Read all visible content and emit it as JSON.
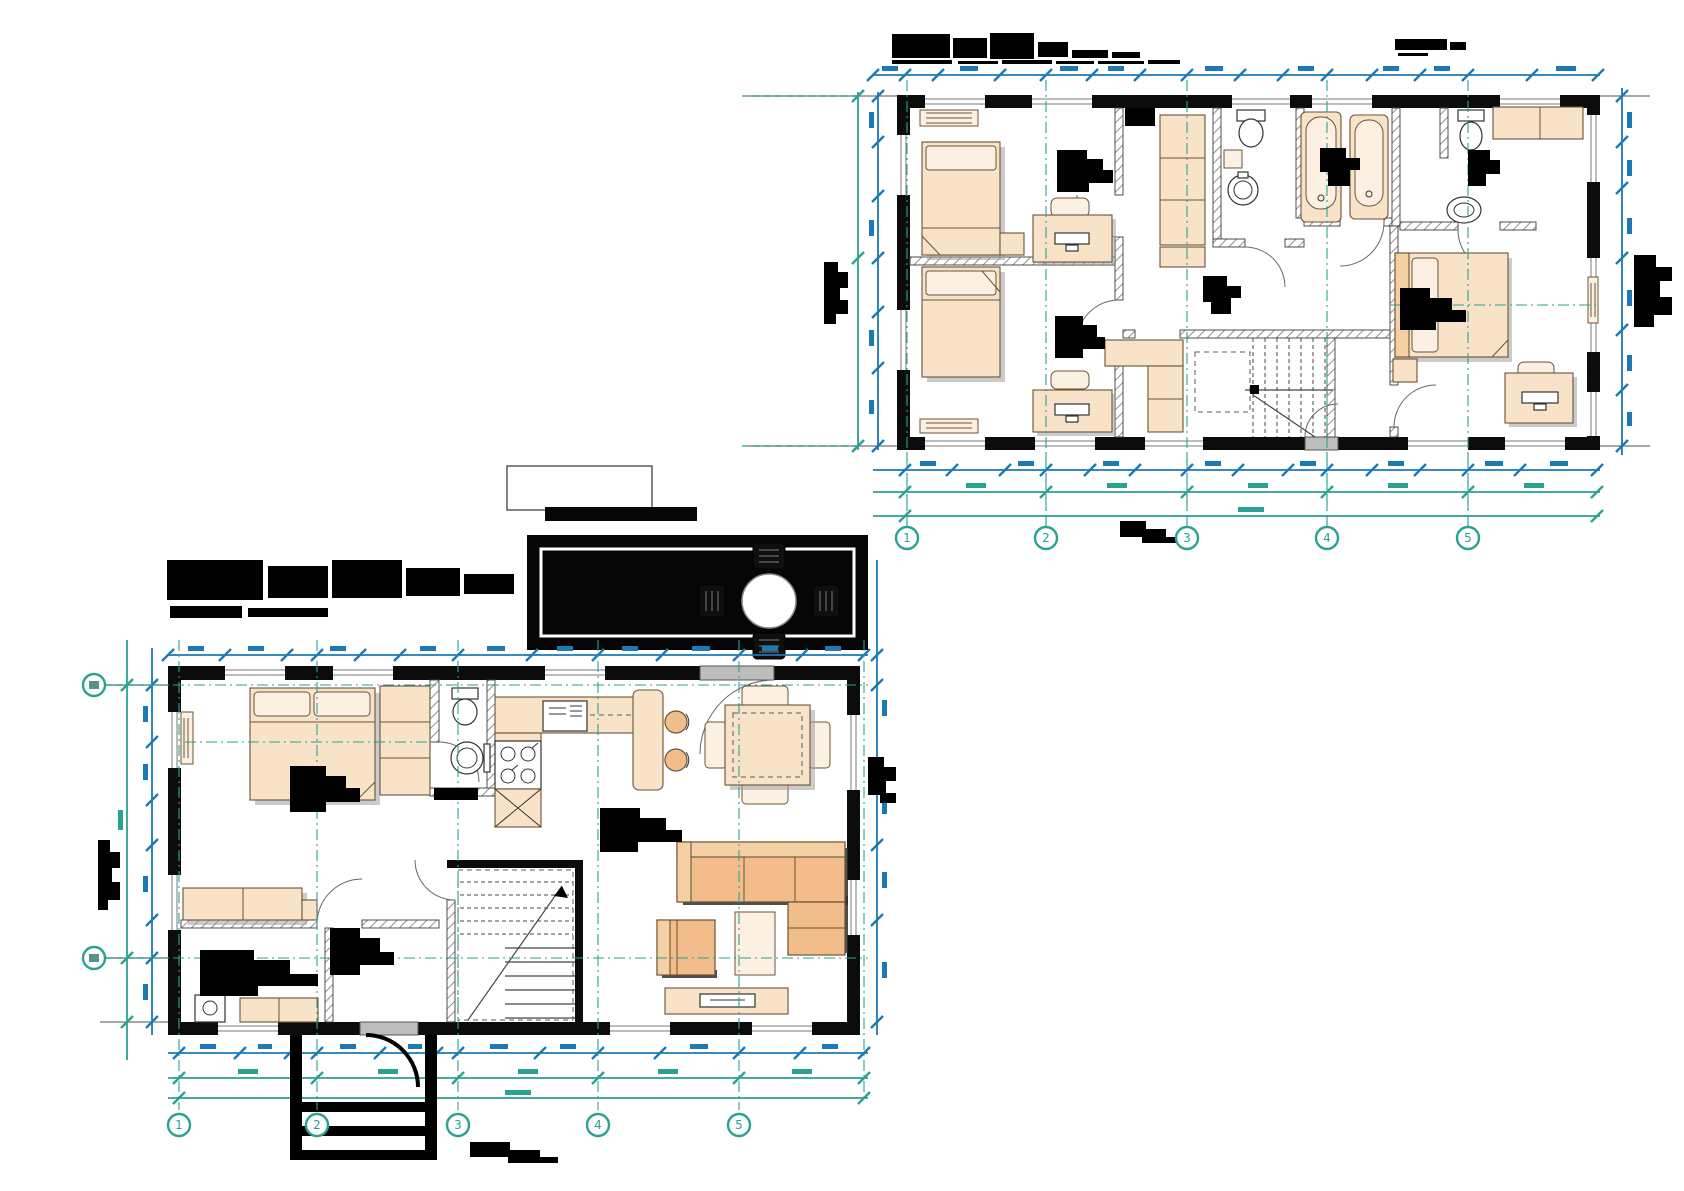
{
  "document": {
    "type": "architectural-floor-plan-drawing",
    "plans": [
      {
        "id": "second-floor-plan",
        "position": "top-right",
        "title_legible": false
      },
      {
        "id": "first-floor-plan",
        "position": "bottom-left",
        "title_legible": false
      }
    ]
  },
  "grid": {
    "numeric": [
      "1",
      "2",
      "3",
      "4",
      "5"
    ]
  },
  "colors": {
    "dimension_blue": "#1b79b4",
    "axis_teal": "#2ba192",
    "wall_black": "#0c0c0c",
    "deck_black": "#060606",
    "hatch_gray": "#909090",
    "furn_light": "#f8e3c8",
    "furn_mid": "#f5d0a4",
    "furn_strong": "#f2bd8a",
    "furn_pale": "#fcf0e2",
    "fixture_white": "#ffffff",
    "shadow_gray": "#a0a0a0",
    "dark_shadow": "#2f2f2f",
    "door_gray": "#bdbdbd",
    "line_brown": "#6b5335",
    "stair_gray": "#474747",
    "label_black": "#000000"
  }
}
